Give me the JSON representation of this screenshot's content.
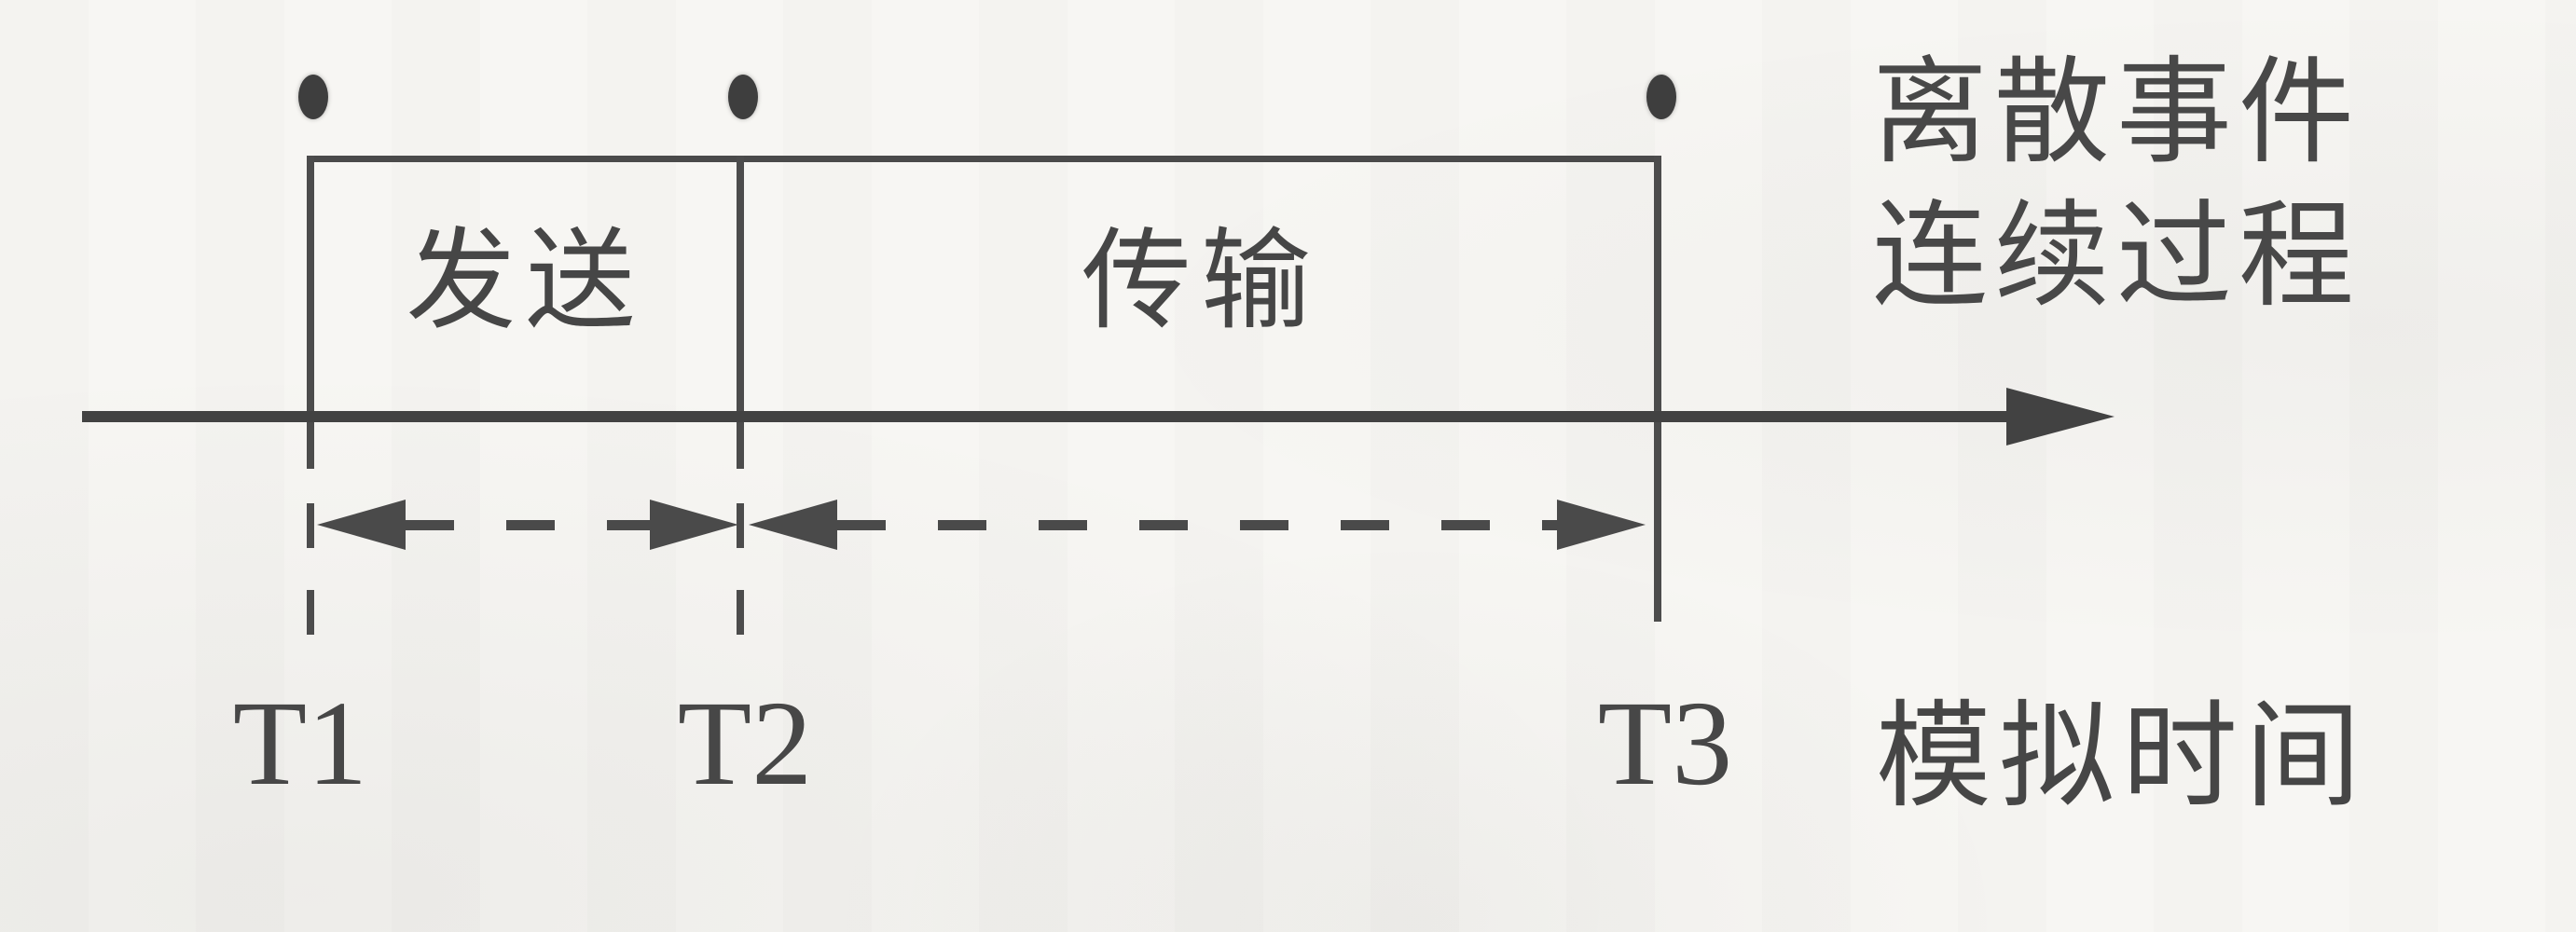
{
  "figure": {
    "ink_color": "#4a4a4a",
    "paper_color": "#f7f6f3",
    "events": [
      {
        "time_label": "T1"
      },
      {
        "time_label": "T2"
      },
      {
        "time_label": "T3"
      }
    ],
    "phases": [
      {
        "label": "发送"
      },
      {
        "label": "传输"
      }
    ],
    "legend": {
      "line1": "离散事件",
      "line2": "连续过程"
    },
    "axis_label": "模拟时间"
  }
}
